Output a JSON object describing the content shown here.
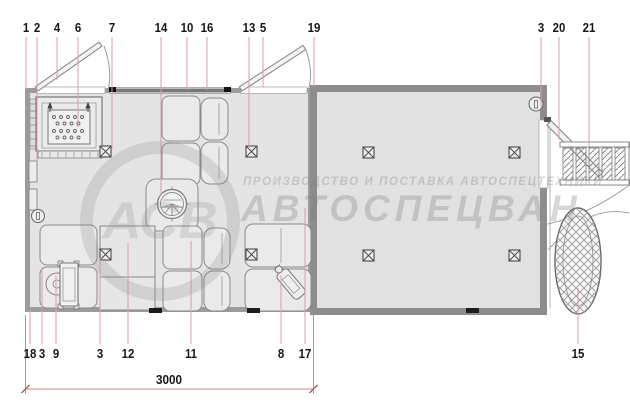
{
  "watermark": {
    "logo_text": "АСВ",
    "tagline": "ПРОИЗВОДСТВО И ПОСТАВКА АВТОСПЕЦТЕХНИКИ",
    "brand": "АВТОСПЕЦВАН"
  },
  "dimension_label": "3000",
  "callouts": {
    "top": [
      "1",
      "2",
      "4",
      "6",
      "7",
      "14",
      "10",
      "16",
      "13",
      "5",
      "19",
      "3",
      "20",
      "21"
    ],
    "bottom": [
      "18",
      "3",
      "9",
      "3",
      "12",
      "11",
      "8",
      "17",
      "15"
    ]
  }
}
